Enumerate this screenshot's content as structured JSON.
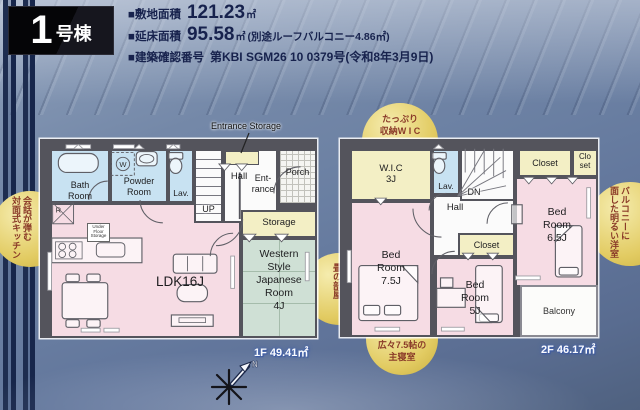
{
  "header": {
    "unit_number": "1",
    "unit_suffix": "号棟",
    "specs": [
      {
        "label": "■敷地面積",
        "value": "121.23",
        "unit": "㎡",
        "note": ""
      },
      {
        "label": "■延床面積",
        "value": "95.58",
        "unit": "㎡",
        "note": "(別途ルーフバルコニー4.86㎡)"
      },
      {
        "label": "■建築確認番号",
        "value": "第KBI SGM26 10 0379号(令和8年3月9日)",
        "unit": "",
        "note": ""
      }
    ]
  },
  "floor1": {
    "area_label": "1F 49.41㎡",
    "entrance_storage": "Entrance Storage",
    "rooms": {
      "bath": "Bath\nRoom",
      "powder": "Powder\nRoom",
      "lav": "Lav.",
      "up": "UP",
      "hall": "Hall",
      "entrance": "Ent-\nrance",
      "porch": "Porch",
      "storage": "Storage",
      "western": "Western\nStyle\nJapanese\nRoom\n4J",
      "ldk": "LDK16J",
      "fridge": "R",
      "washer": "W",
      "under_floor": "Under\nFloor\nStorage"
    }
  },
  "floor2": {
    "area_label": "2F 46.17㎡",
    "rooms": {
      "wic": "W.I.C\n3J",
      "lav": "Lav.",
      "dn": "DN",
      "hall": "Hall",
      "closet_top": "Closet",
      "closet_small": "Clo\nset",
      "closet_mid": "Closet",
      "bed_75": "Bed\nRoom\n7.5J",
      "bed_5": "Bed\nRoom\n5J",
      "bed_65": "Bed\nRoom\n6.5J",
      "balcony": "Balcony"
    }
  },
  "callouts": {
    "kitchen": "会話が弾む\n対面式キッチン",
    "tatami": "心安らぐ\n畳の部屋",
    "wic": "たっぷり\n収納W I C",
    "balcony_room": "バルコニーに\n面した明るい洋室",
    "master": "広々7.5帖の\n主寝室"
  },
  "compass": {
    "north": "N"
  },
  "colors": {
    "wall": "#54545c",
    "room_pink": "#f6dce4",
    "room_blue": "#c8e2f2",
    "room_yellow": "#f3efc5",
    "room_green": "#cfe0d5",
    "bubble_yellow": "#e2cb62",
    "background_blue": "#6a7fa2",
    "header_navy": "#17224d",
    "floor_label_white": "#ffffff"
  }
}
